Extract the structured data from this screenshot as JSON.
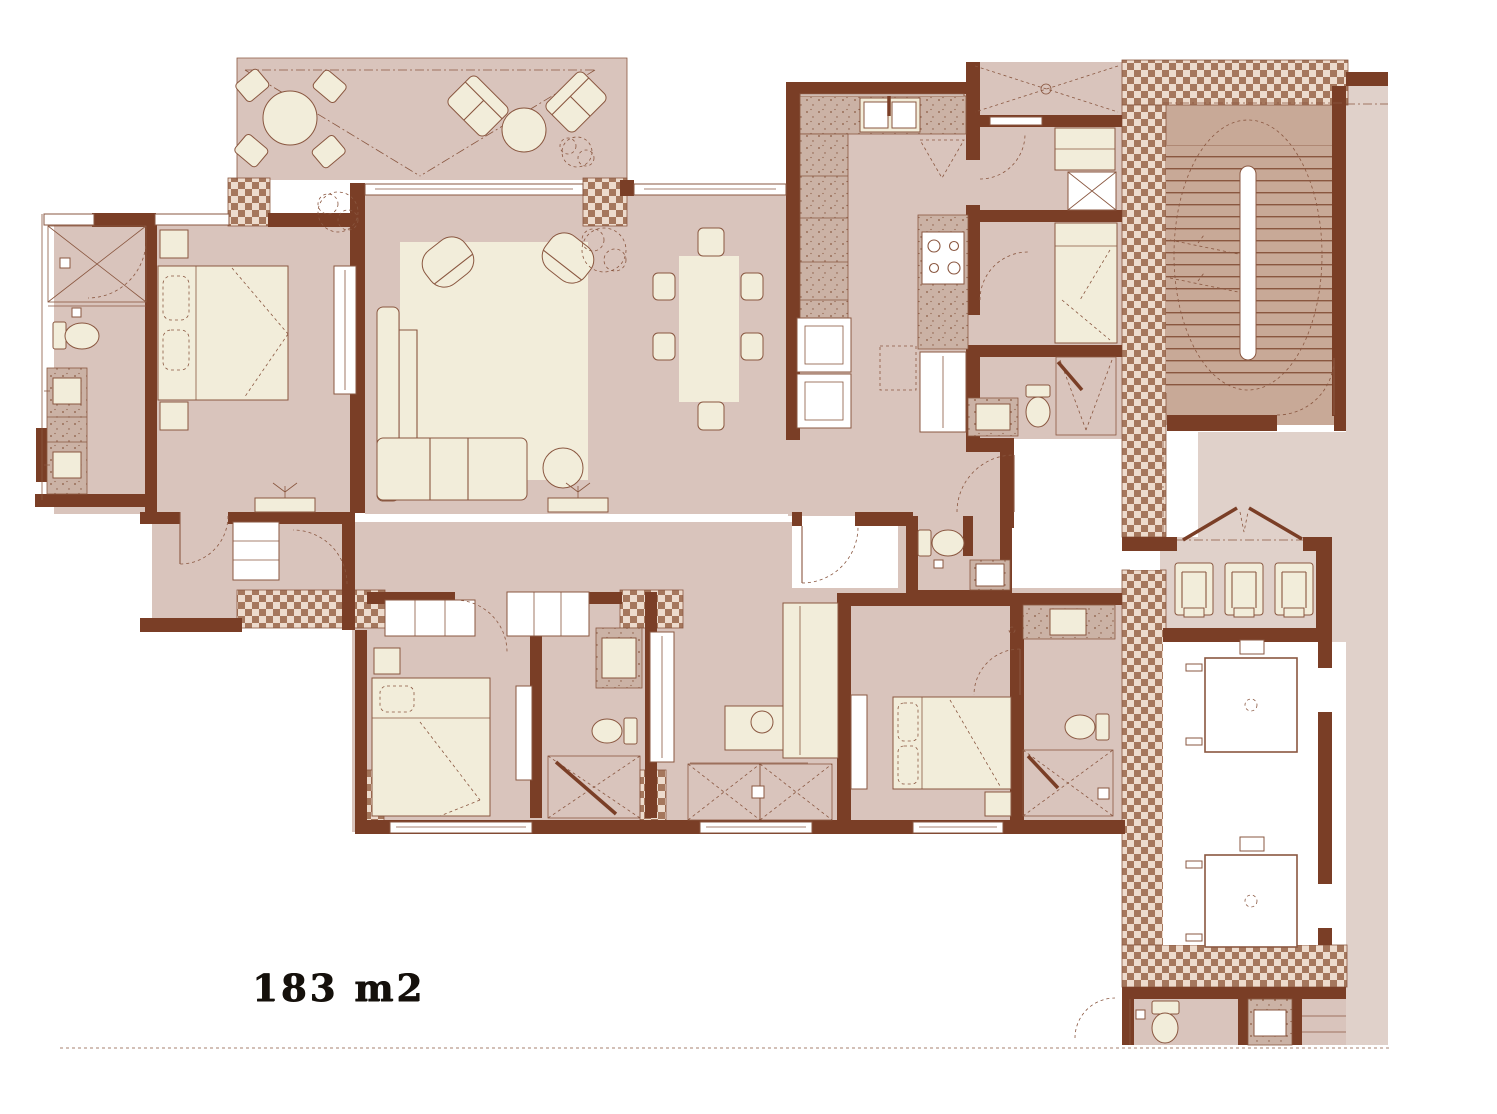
{
  "plan": {
    "area_label": "183 m2"
  },
  "colors": {
    "wall": "#7a3e26",
    "floor": "#d9c4bc",
    "floor2": "#e0d1ca",
    "stairfloor": "#c8a997",
    "cream": "#f2edda",
    "line": "#8a5740",
    "checker_light": "#eddbcd",
    "checker_dark": "#a5775d",
    "counter_base": "#cbb2a5",
    "counter_dot": "#8a5a42",
    "text": "#15100b",
    "background": "#ffffff"
  }
}
